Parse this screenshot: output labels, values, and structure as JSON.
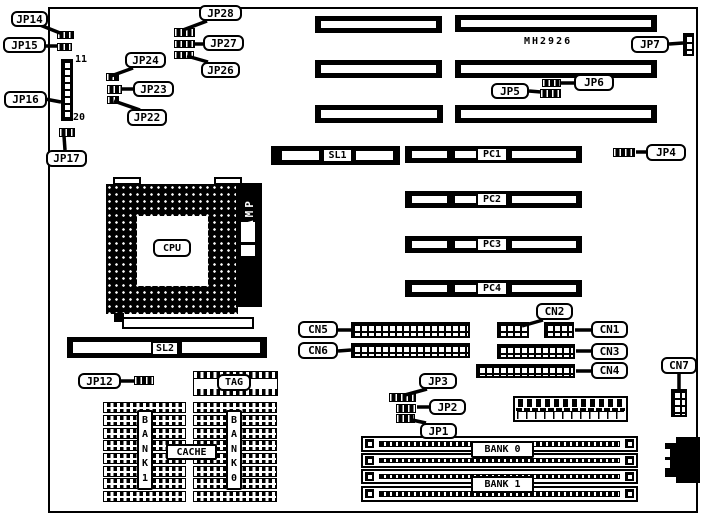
{
  "board": {
    "marking": "MH2926"
  },
  "callouts": [
    {
      "id": "jp14",
      "text": "JP14",
      "box": [
        11,
        11,
        37,
        16
      ],
      "line": [
        40,
        25,
        60,
        33
      ]
    },
    {
      "id": "jp15",
      "text": "JP15",
      "box": [
        3,
        37,
        43,
        16
      ],
      "line": [
        45,
        46,
        58,
        46
      ]
    },
    {
      "id": "jp16",
      "text": "JP16",
      "box": [
        4,
        91,
        43,
        17
      ],
      "line": [
        45,
        99,
        61,
        102
      ]
    },
    {
      "id": "jp17",
      "text": "JP17",
      "box": [
        46,
        150,
        41,
        17
      ],
      "line": [
        65,
        150,
        64,
        136
      ]
    },
    {
      "id": "jp24",
      "text": "JP24",
      "box": [
        125,
        52,
        41,
        16
      ],
      "line": [
        133,
        68,
        111,
        76
      ]
    },
    {
      "id": "jp23",
      "text": "JP23",
      "box": [
        133,
        81,
        41,
        16
      ],
      "line": [
        134,
        89,
        122,
        89
      ]
    },
    {
      "id": "jp22",
      "text": "JP22",
      "box": [
        127,
        109,
        40,
        17
      ],
      "line": [
        140,
        110,
        114,
        101
      ]
    },
    {
      "id": "jp28",
      "text": "JP28",
      "box": [
        199,
        5,
        43,
        16
      ],
      "line": [
        207,
        21,
        183,
        30
      ]
    },
    {
      "id": "jp27",
      "text": "JP27",
      "box": [
        203,
        35,
        41,
        16
      ],
      "line": [
        203,
        44,
        195,
        44
      ]
    },
    {
      "id": "jp26",
      "text": "JP26",
      "box": [
        201,
        62,
        39,
        16
      ],
      "line": [
        208,
        62,
        187,
        56
      ]
    },
    {
      "id": "jp7",
      "text": "JP7",
      "box": [
        631,
        36,
        38,
        17
      ],
      "line": [
        669,
        44,
        683,
        43
      ]
    },
    {
      "id": "jp5",
      "text": "JP5",
      "box": [
        491,
        83,
        38,
        16
      ],
      "line": [
        529,
        91,
        541,
        92
      ]
    },
    {
      "id": "jp6",
      "text": "JP6",
      "box": [
        574,
        74,
        40,
        17
      ],
      "line": [
        574,
        83,
        561,
        83
      ]
    },
    {
      "id": "jp4",
      "text": "JP4",
      "box": [
        646,
        144,
        40,
        17
      ],
      "line": [
        646,
        152,
        636,
        152
      ]
    },
    {
      "id": "jp12",
      "text": "JP12",
      "box": [
        78,
        373,
        43,
        16
      ],
      "line": [
        121,
        381,
        134,
        381
      ]
    },
    {
      "id": "cn5",
      "text": "CN5",
      "box": [
        298,
        321,
        40,
        17
      ],
      "line": [
        338,
        330,
        351,
        330
      ]
    },
    {
      "id": "cn6",
      "text": "CN6",
      "box": [
        298,
        342,
        40,
        17
      ],
      "line": [
        338,
        351,
        351,
        350
      ]
    },
    {
      "id": "cn2",
      "text": "CN2",
      "box": [
        536,
        303,
        37,
        17
      ],
      "line": [
        543,
        320,
        522,
        326
      ]
    },
    {
      "id": "cn1",
      "text": "CN1",
      "box": [
        591,
        321,
        37,
        17
      ],
      "line": [
        591,
        330,
        575,
        330
      ]
    },
    {
      "id": "cn3",
      "text": "CN3",
      "box": [
        591,
        343,
        37,
        17
      ],
      "line": [
        591,
        351,
        576,
        351
      ]
    },
    {
      "id": "cn4",
      "text": "CN4",
      "box": [
        591,
        362,
        37,
        17
      ],
      "line": [
        591,
        371,
        576,
        371
      ]
    },
    {
      "id": "cn7",
      "text": "CN7",
      "box": [
        661,
        357,
        36,
        17
      ],
      "line": [
        679,
        374,
        679,
        389
      ]
    },
    {
      "id": "jp3",
      "text": "JP3",
      "box": [
        419,
        373,
        38,
        16
      ],
      "line": [
        427,
        389,
        405,
        395
      ]
    },
    {
      "id": "jp2",
      "text": "JP2",
      "box": [
        429,
        399,
        37,
        16
      ],
      "line": [
        429,
        407,
        417,
        407
      ]
    },
    {
      "id": "jp1",
      "text": "JP1",
      "box": [
        420,
        423,
        37,
        16
      ],
      "line": [
        426,
        423,
        412,
        420
      ]
    }
  ],
  "inline_labels": [
    {
      "id": "sl1",
      "text": "SL1",
      "box": [
        322,
        148,
        31,
        15
      ]
    },
    {
      "id": "sl2",
      "text": "SL2",
      "box": [
        151,
        341,
        28,
        15
      ]
    },
    {
      "id": "pc1",
      "text": "PC1",
      "box": [
        476,
        147,
        32,
        15
      ]
    },
    {
      "id": "pc2",
      "text": "PC2",
      "box": [
        476,
        192,
        32,
        15
      ]
    },
    {
      "id": "pc3",
      "text": "PC3",
      "box": [
        476,
        237,
        32,
        15
      ]
    },
    {
      "id": "pc4",
      "text": "PC4",
      "box": [
        476,
        281,
        32,
        15
      ]
    },
    {
      "id": "cpu",
      "text": "CPU",
      "box": [
        153,
        239,
        38,
        18
      ],
      "round": true
    },
    {
      "id": "tag",
      "text": "TAG",
      "box": [
        217,
        374,
        34,
        17
      ],
      "round": true
    },
    {
      "id": "cache",
      "text": "CACHE",
      "box": [
        166,
        444,
        51,
        16
      ]
    },
    {
      "id": "bank0",
      "text": "BANK 0",
      "box": [
        471,
        441,
        63,
        17
      ]
    },
    {
      "id": "bank1",
      "text": "BANK 1",
      "box": [
        471,
        476,
        63,
        17
      ]
    }
  ],
  "vertical_labels": [
    {
      "id": "bank1-vertical",
      "text": "B\nA\nN\nK\n1",
      "box": [
        137,
        410,
        16,
        80
      ]
    },
    {
      "id": "bank0-vertical",
      "text": "B\nA\nN\nK\n0",
      "box": [
        226,
        410,
        16,
        80
      ]
    }
  ],
  "pin_labels": [
    {
      "id": "pin-11",
      "text": "11",
      "box": [
        75,
        54,
        14,
        12
      ]
    },
    {
      "id": "pin-20",
      "text": "20",
      "box": [
        73,
        112,
        14,
        12
      ]
    }
  ],
  "isa_slots": [
    [
      315,
      16,
      127,
      17
    ],
    [
      315,
      60,
      127,
      18
    ],
    [
      315,
      105,
      128,
      18
    ],
    [
      455,
      15,
      202,
      17
    ],
    [
      455,
      60,
      202,
      18
    ],
    [
      455,
      105,
      202,
      18
    ]
  ],
  "card_slots": [
    {
      "id": "sl1",
      "box": [
        271,
        146,
        129,
        19
      ],
      "segments": [
        [
          11,
          37
        ],
        [
          85,
          37
        ]
      ]
    },
    {
      "id": "sl2",
      "box": [
        67,
        337,
        200,
        21
      ],
      "segments": [
        [
          6,
          78
        ],
        [
          115,
          78
        ]
      ]
    },
    {
      "id": "pc1",
      "box": [
        405,
        146,
        177,
        17
      ],
      "segments": [
        [
          7,
          35
        ],
        [
          50,
          21
        ],
        [
          107,
          64
        ]
      ]
    },
    {
      "id": "pc2",
      "box": [
        405,
        191,
        177,
        17
      ],
      "segments": [
        [
          7,
          35
        ],
        [
          50,
          21
        ],
        [
          107,
          64
        ]
      ]
    },
    {
      "id": "pc3",
      "box": [
        405,
        236,
        177,
        17
      ],
      "segments": [
        [
          7,
          35
        ],
        [
          50,
          21
        ],
        [
          107,
          64
        ]
      ]
    },
    {
      "id": "pc4",
      "box": [
        405,
        280,
        177,
        17
      ],
      "segments": [
        [
          7,
          35
        ],
        [
          50,
          21
        ],
        [
          107,
          64
        ]
      ]
    }
  ],
  "pin_headers": [
    {
      "id": "cn5",
      "box": [
        351,
        322,
        119,
        16
      ]
    },
    {
      "id": "cn6",
      "box": [
        351,
        343,
        119,
        15
      ]
    },
    {
      "id": "cn2",
      "box": [
        497,
        322,
        32,
        16
      ]
    },
    {
      "id": "cn1",
      "box": [
        544,
        322,
        30,
        16
      ]
    },
    {
      "id": "cn3",
      "box": [
        497,
        344,
        78,
        15
      ]
    },
    {
      "id": "cn4",
      "box": [
        476,
        364,
        99,
        14
      ]
    },
    {
      "id": "cn7",
      "box": [
        671,
        389,
        16,
        28
      ]
    },
    {
      "id": "jp7",
      "box": [
        683,
        33,
        11,
        23
      ]
    },
    {
      "id": "jp16",
      "box": [
        61,
        59,
        12,
        62
      ]
    }
  ],
  "jumpers": [
    {
      "id": "jp14",
      "box": [
        57,
        31,
        17,
        8
      ]
    },
    {
      "id": "jp15",
      "box": [
        57,
        43,
        15,
        8
      ]
    },
    {
      "id": "jp17",
      "box": [
        59,
        128,
        16,
        9
      ]
    },
    {
      "id": "jp22",
      "box": [
        107,
        96,
        12,
        8
      ]
    },
    {
      "id": "jp23",
      "box": [
        107,
        85,
        15,
        9
      ]
    },
    {
      "id": "jp24",
      "box": [
        106,
        73,
        13,
        8
      ]
    },
    {
      "id": "jp26",
      "box": [
        174,
        51,
        20,
        8
      ]
    },
    {
      "id": "jp27",
      "box": [
        174,
        40,
        21,
        8
      ]
    },
    {
      "id": "jp28",
      "box": [
        174,
        28,
        21,
        9
      ]
    },
    {
      "id": "jp5",
      "box": [
        540,
        89,
        21,
        9
      ]
    },
    {
      "id": "jp6",
      "box": [
        542,
        79,
        19,
        8
      ]
    },
    {
      "id": "jp4",
      "box": [
        613,
        148,
        22,
        9
      ]
    },
    {
      "id": "jp12",
      "box": [
        134,
        376,
        20,
        9
      ]
    },
    {
      "id": "jp3",
      "box": [
        389,
        393,
        27,
        9
      ]
    },
    {
      "id": "jp2",
      "box": [
        396,
        404,
        20,
        9
      ]
    },
    {
      "id": "jp1",
      "box": [
        396,
        414,
        19,
        9
      ]
    }
  ],
  "chips": [
    [
      103,
      402,
      83,
      11
    ],
    [
      103,
      415,
      83,
      11
    ],
    [
      103,
      428,
      83,
      11
    ],
    [
      103,
      440,
      83,
      11
    ],
    [
      103,
      453,
      83,
      11
    ],
    [
      103,
      466,
      83,
      11
    ],
    [
      103,
      478,
      83,
      11
    ],
    [
      103,
      491,
      83,
      11
    ],
    [
      193,
      402,
      84,
      11
    ],
    [
      193,
      415,
      84,
      11
    ],
    [
      193,
      428,
      84,
      11
    ],
    [
      193,
      440,
      84,
      11
    ],
    [
      193,
      453,
      84,
      11
    ],
    [
      193,
      466,
      84,
      11
    ],
    [
      193,
      478,
      84,
      11
    ],
    [
      193,
      491,
      84,
      11
    ]
  ],
  "tag_chip": [
    193,
    371,
    85,
    25
  ],
  "simm_slots": [
    [
      361,
      436,
      277,
      16
    ],
    [
      361,
      453,
      277,
      15
    ],
    [
      361,
      469,
      277,
      15
    ],
    [
      361,
      486,
      277,
      16
    ]
  ],
  "cpu": {
    "socket": [
      106,
      184,
      132,
      130
    ],
    "inner": [
      137,
      216,
      71,
      70
    ],
    "tabs": [
      [
        113,
        177,
        28,
        8
      ],
      [
        214,
        177,
        28,
        8
      ]
    ],
    "bar": [
      122,
      317,
      132,
      12
    ],
    "step": [
      114,
      313,
      10,
      9
    ]
  },
  "amp": {
    "box": [
      236,
      183,
      26,
      124
    ],
    "text": "AMP",
    "slots": [
      [
        241,
        222,
        14,
        20
      ],
      [
        241,
        245,
        14,
        11
      ]
    ]
  },
  "power": {
    "box": [
      513,
      396,
      115,
      26
    ]
  },
  "keyboard": {
    "blocks": [
      [
        676,
        437,
        24,
        46
      ],
      [
        665,
        443,
        12,
        34
      ]
    ],
    "notches": [
      [
        663,
        449,
        7,
        8
      ],
      [
        663,
        460,
        7,
        8
      ]
    ]
  }
}
